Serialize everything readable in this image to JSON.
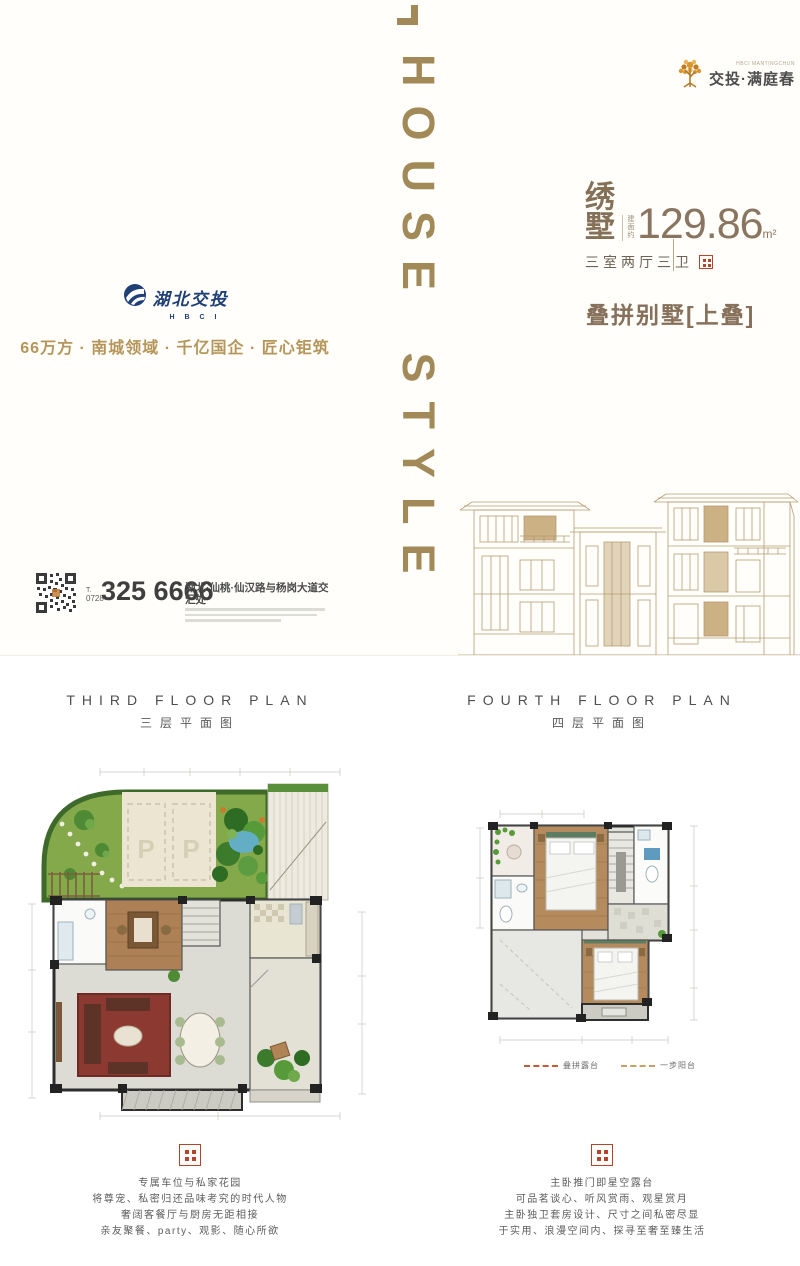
{
  "brand": {
    "logo_sub_en": "HBCI MANTINGCHUN",
    "logo_text": "交投·满庭春"
  },
  "poster": {
    "vertical_title": "HOUSE STYLE",
    "unit_name": "绣墅",
    "area_label": "建面约",
    "area_value": "129.86",
    "area_unit": "m²",
    "layout_text": "三室两厅三卫",
    "product_type": "叠拼别墅[上叠]",
    "developer_name": "湖北交投",
    "developer_abbr": "H B C I",
    "tagline": "66万方 · 南城领域 · 千亿国企 · 匠心钜筑",
    "phone_prefix": "T.",
    "phone_area": "0728",
    "phone_number": "325 6666",
    "address": "湖北·仙桃·仙汉路与杨岗大道交汇处"
  },
  "plans": {
    "left": {
      "title_en": "THIRD FLOOR PLAN",
      "title_cn": "三层平面图",
      "parking_label": "P",
      "description": [
        "专属车位与私家花园",
        "将尊宠、私密归还品味考究的时代人物",
        "奢阔客餐厅与厨房无距相接",
        "亲友聚餐、party、观影、随心所欲"
      ]
    },
    "right": {
      "title_en": "FOURTH FLOOR PLAN",
      "title_cn": "四层平面图",
      "legend": [
        {
          "label": "叠拼露台",
          "color": "#c65a33"
        },
        {
          "label": "一步阳台",
          "color": "#c8a062"
        }
      ],
      "description": [
        "主卧推门即星空露台",
        "可品茗谈心、听风赏雨、观星赏月",
        "主卧独卫套房设计、尺寸之间私密尽显",
        "于实用、浪漫空间内、探寻至奢至臻生活"
      ]
    }
  },
  "colors": {
    "title_gold": "#a28a58",
    "brown_text": "#87705a",
    "tagline_gold": "#b59559",
    "developer_navy": "#1f3f77",
    "seal_red": "#b5442c",
    "sketch_line": "#b49d72"
  }
}
